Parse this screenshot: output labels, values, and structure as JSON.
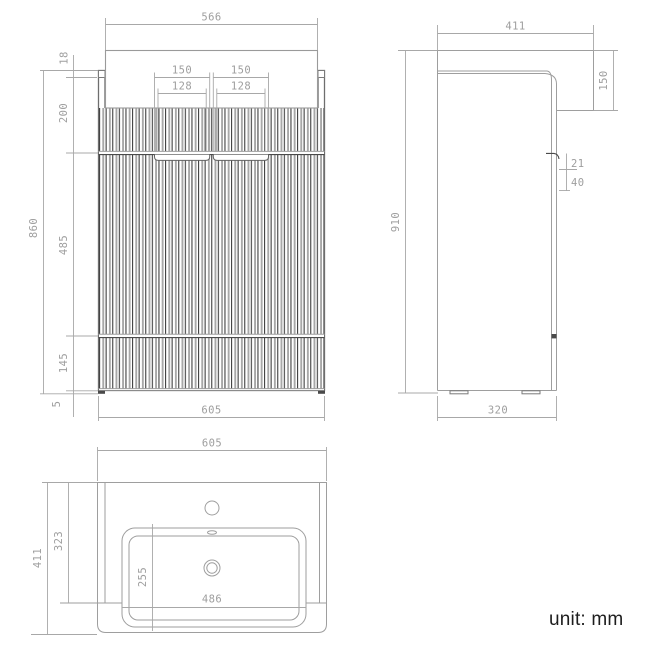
{
  "unit_note": "unit: mm",
  "colors": {
    "line_gray": "#9e9e9e",
    "dark_line": "#4a4a4a",
    "dim_text": "#9e9e9e",
    "note_text": "#1d1d1d"
  },
  "front": {
    "top_width": "566",
    "counter_lip": "18",
    "upper_section": "200",
    "door_section": "485",
    "lower_section": "145",
    "foot_height": "5",
    "body_height": "860",
    "handle_outer_left": "150",
    "handle_outer_right": "150",
    "handle_inner_left": "128",
    "handle_inner_right": "128",
    "bottom_width": "605"
  },
  "side": {
    "top_depth": "411",
    "basin_front_height": "150",
    "total_height": "910",
    "handle_gap": "21",
    "handle_recess": "40",
    "bottom_depth": "320"
  },
  "top": {
    "width": "605",
    "depth": "411",
    "deck_depth": "323",
    "basin_depth": "255",
    "basin_width": "486"
  }
}
